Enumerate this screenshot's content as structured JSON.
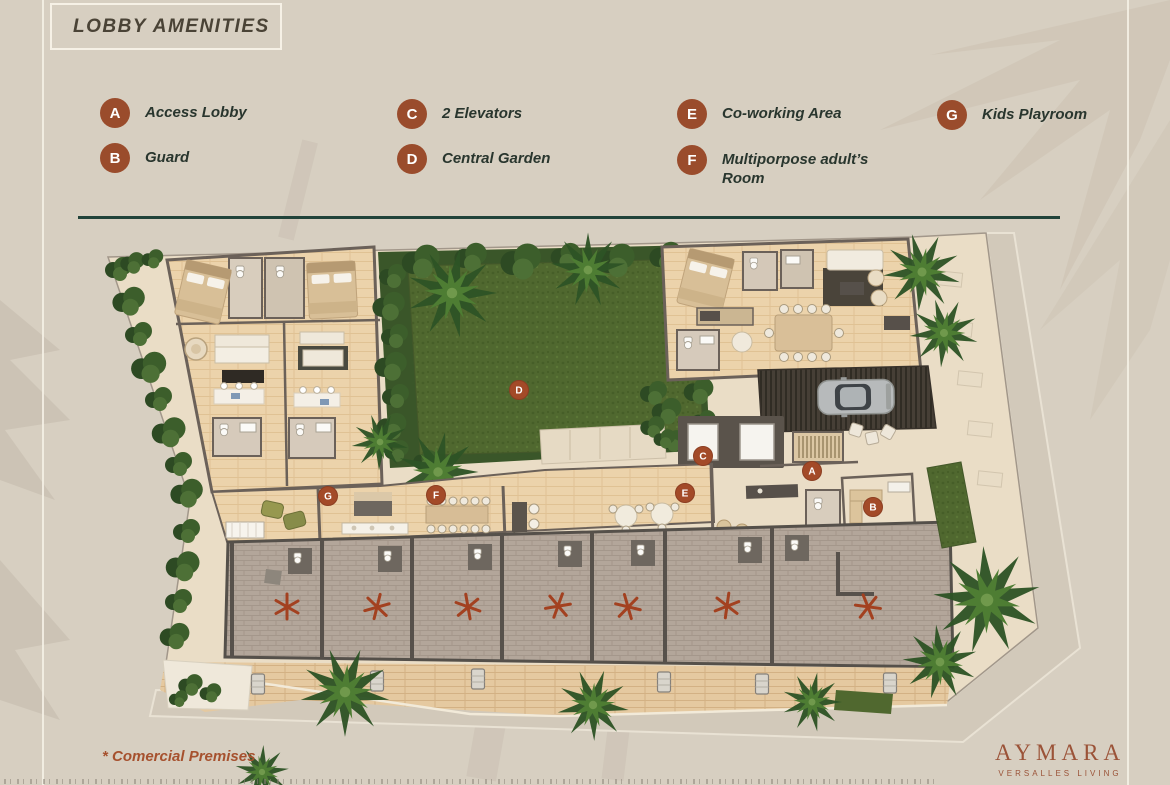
{
  "colors": {
    "background": "#d7cfc1",
    "badge_rust": "#9a4c2c",
    "legend_text": "#29362e",
    "divider_teal": "#21433a",
    "title_text": "#4a4336",
    "footnote_rust": "#a6512e",
    "brand_rust": "#9b5338",
    "grass_green": "#50682f",
    "wood_floor": "#ecd3ab",
    "commercial_floor": "#b3a69a"
  },
  "header": {
    "title": "LOBBY AMENITIES"
  },
  "legend": {
    "items": [
      {
        "letter": "A",
        "label": "Access Lobby"
      },
      {
        "letter": "B",
        "label": "Guard"
      },
      {
        "letter": "C",
        "label": "2 Elevators"
      },
      {
        "letter": "D",
        "label": "Central Garden"
      },
      {
        "letter": "E",
        "label": "Co-working Area"
      },
      {
        "letter": "F",
        "label": "Multiporpose adult’s Room"
      },
      {
        "letter": "G",
        "label": "Kids Playroom"
      }
    ]
  },
  "plan": {
    "markers": [
      "A",
      "B",
      "C",
      "D",
      "E",
      "F",
      "G"
    ],
    "commercial_units_starred": 7
  },
  "footnote": {
    "text": "* Comercial Premises"
  },
  "brand": {
    "name": "AYMARA",
    "tagline": "VERSALLES LIVING"
  }
}
